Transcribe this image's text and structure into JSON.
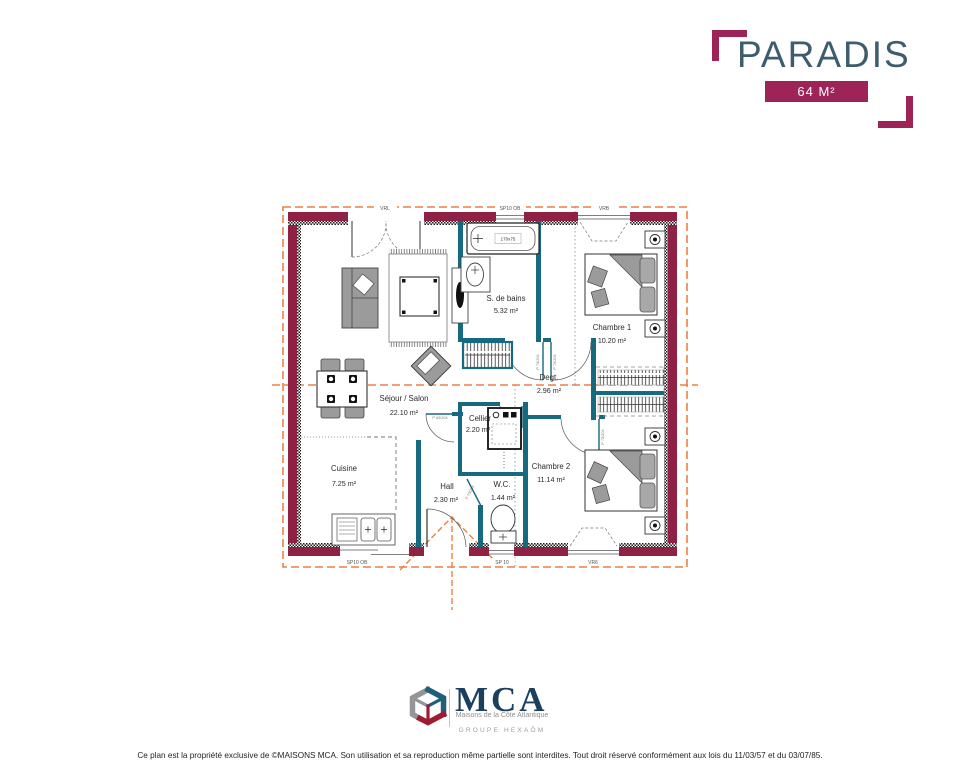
{
  "header": {
    "title": "PARADIS",
    "area_badge": "64 M²"
  },
  "plan": {
    "rooms": {
      "sdb": {
        "name": "S. de bains",
        "area": "5.32 m²"
      },
      "ch1": {
        "name": "Chambre 1",
        "area": "10.20 m²"
      },
      "degt": {
        "name": "Degt.",
        "area": "2.96 m²"
      },
      "sejour": {
        "name": "Séjour / Salon",
        "area": "22.10 m²"
      },
      "cellier": {
        "name": "Cellier",
        "area": "2.20 m²"
      },
      "ch2": {
        "name": "Chambre 2",
        "area": "11.14 m²"
      },
      "cuisine": {
        "name": "Cuisine",
        "area": "7.25 m²"
      },
      "hall": {
        "name": "Hall",
        "area": "2.30 m²"
      },
      "wc": {
        "name": "W.C.",
        "area": "1.44 m²"
      }
    },
    "openings": {
      "top": [
        "VRL",
        "SP10 OB",
        "VRB"
      ],
      "bottom": [
        "SP10 OB",
        "SP 10",
        "VR6"
      ],
      "door_label_interior": "P 73/204",
      "door_label_sejour": "P 63/204",
      "bathtub": "170x75"
    },
    "colors": {
      "exterior_wall": "#8e2144",
      "interior_wall": "#16697e",
      "roof_lines": "#ee8044",
      "accent": "#9e2357",
      "title": "#3c5d6e"
    }
  },
  "footer": {
    "logo": {
      "brand": "MCA",
      "tagline": "Maisons de la Côte Atlantique",
      "group": "GROUPE HEXAŌM"
    },
    "disclaimer": "Ce plan est la propriété exclusive de ©MAISONS MCA. Son utilisation et sa reproduction même partielle sont interdites. Tout droit réservé conformément aux lois du 11/03/57 et du 03/07/85."
  }
}
